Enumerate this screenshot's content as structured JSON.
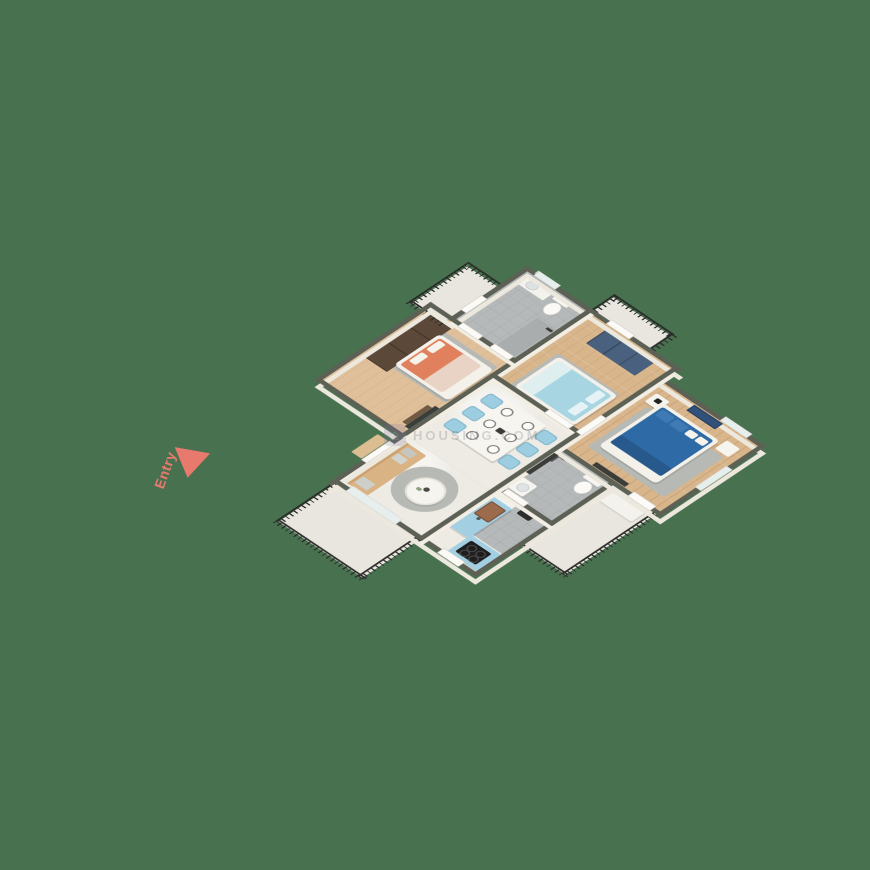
{
  "scene": {
    "description": "3D isometric floor-plan render of an apartment on a green background",
    "background_color": "#48714F",
    "entry_label": "Entry",
    "entry_color": "#E87A6D",
    "watermark_text": "HOUSING.COM",
    "watermark_logo": "house-icon"
  },
  "palette": {
    "wall_top": "#5D6055",
    "wall_face": "#EDE8DD",
    "wood_floor": "#D8B58B",
    "marble_floor": "#EDEBE4",
    "grey_tile_floor": "#B6B9BA",
    "balcony_floor": "#E9E6DF",
    "railing": "#2B2B29",
    "bed_coral": "#E0805C",
    "bed_light_blue": "#A7D6E2",
    "bed_dark_blue": "#2E6BA6",
    "wardrobe_navy": "#49617F",
    "wardrobe_brown": "#5B4839",
    "sofa_tan": "#D9B384",
    "dining_chair_blue": "#9CCDE0",
    "kitchen_cabinet_blue": "#A3CFE3",
    "cooktop_black": "#1E1E1E"
  },
  "rooms": [
    {
      "name": "Bedroom 1",
      "floor": "wood",
      "items": [
        "coral double bed",
        "dark brown wardrobe",
        "TV unit"
      ]
    },
    {
      "name": "Common Bathroom",
      "floor": "grey tile",
      "items": [
        "toilet",
        "wash basin counter",
        "shower",
        "mirror"
      ]
    },
    {
      "name": "Bedroom 2",
      "floor": "wood",
      "items": [
        "light blue double bed",
        "navy wardrobe",
        "grey rug"
      ]
    },
    {
      "name": "Master Bedroom",
      "floor": "wood",
      "items": [
        "dark blue double bed",
        "nightstand",
        "wall art",
        "TV panel",
        "white bench"
      ]
    },
    {
      "name": "Dining Area",
      "floor": "marble",
      "items": [
        "white dining table",
        "6 light blue chairs",
        "6 place settings"
      ]
    },
    {
      "name": "Living Area",
      "floor": "marble",
      "items": [
        "tan sofa with grey cushions",
        "round coffee table",
        "round grey rug"
      ]
    },
    {
      "name": "Kitchen",
      "floor": "marble and grey tile",
      "items": [
        "blue island with sink",
        "blue counter with black cooktop",
        "water heater"
      ]
    },
    {
      "name": "Master Bathroom",
      "floor": "grey tile",
      "items": [
        "toilet",
        "wash basin",
        "shower head"
      ]
    },
    {
      "name": "Balconies",
      "floor": "stone",
      "count": 4,
      "items": [
        "black metal railings"
      ]
    }
  ]
}
